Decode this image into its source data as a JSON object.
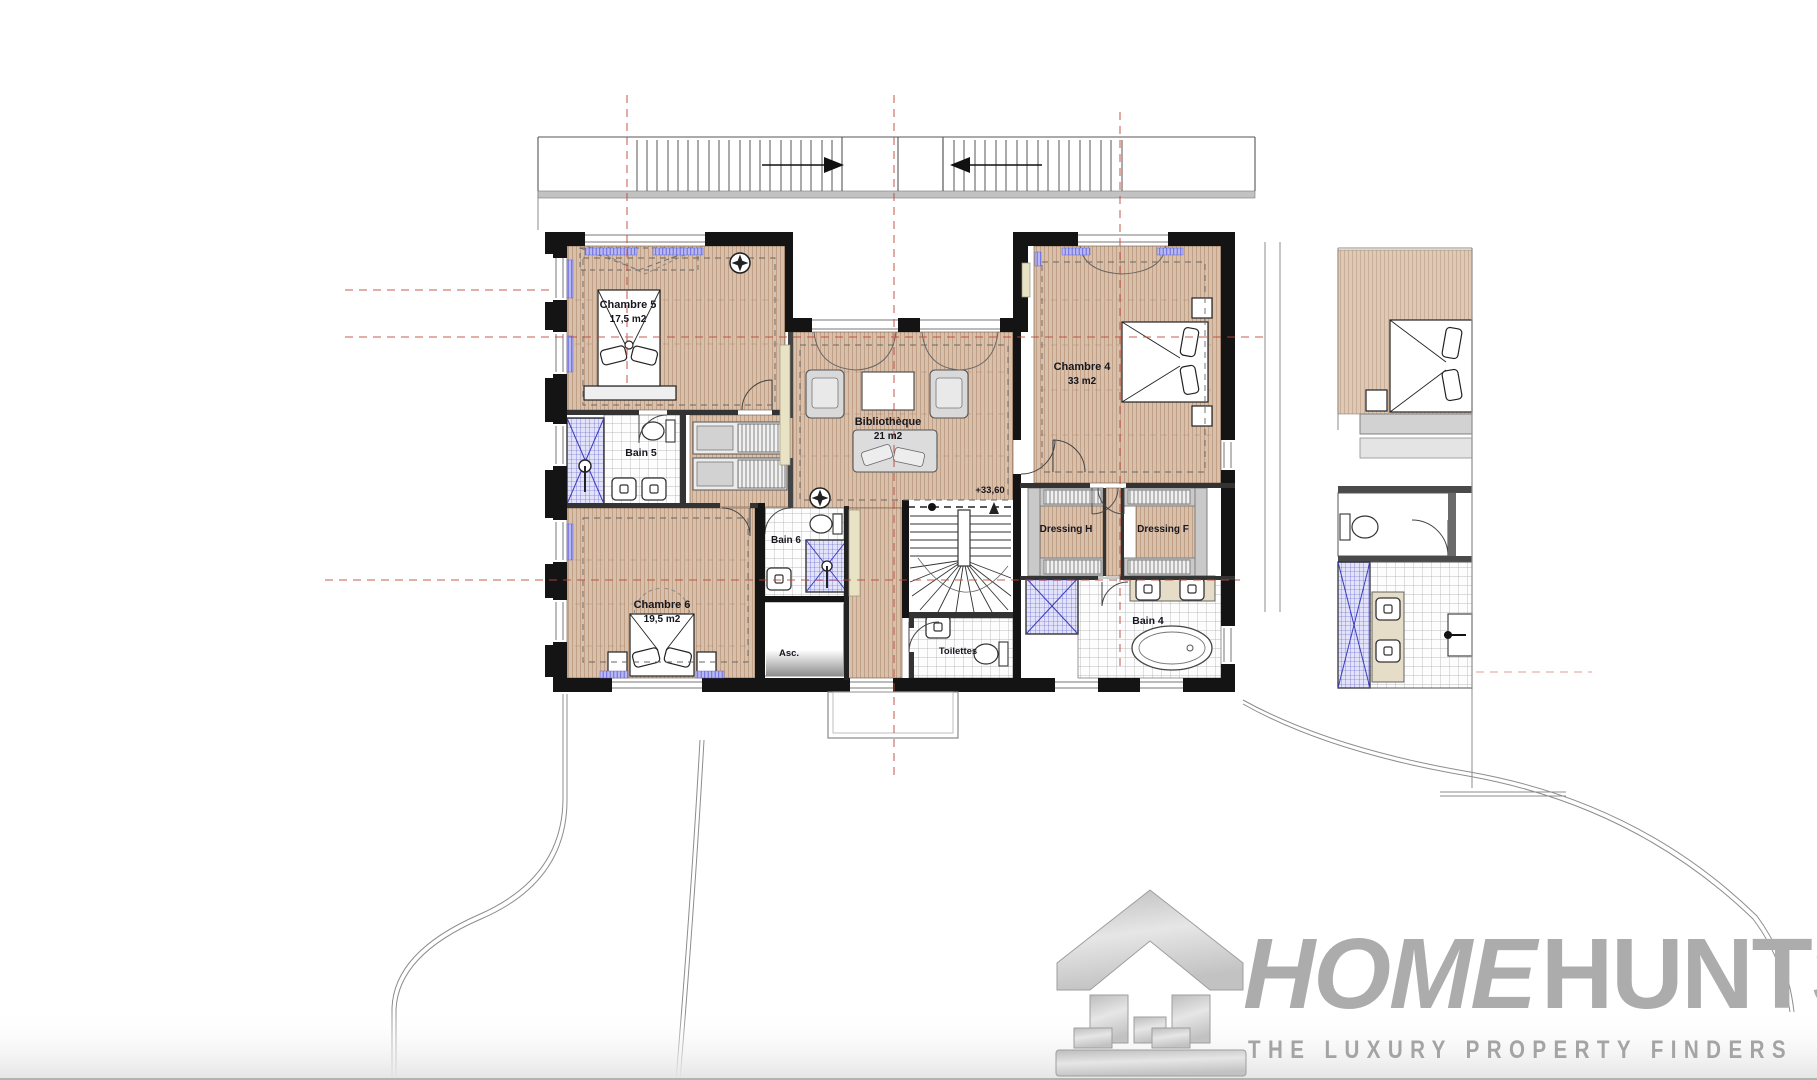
{
  "plan": {
    "rooms": {
      "chambre5": {
        "name": "Chambre 5",
        "area": "17,5 m2"
      },
      "bain5": {
        "name": "Bain 5"
      },
      "chambre6": {
        "name": "Chambre 6",
        "area": "19,5 m2"
      },
      "bain6": {
        "name": "Bain 6"
      },
      "ascenseur": {
        "name": "Asc."
      },
      "toilettes": {
        "name": "Toilettes"
      },
      "bibliotheque": {
        "name": "Bibliothèque",
        "area": "21 m2"
      },
      "chambre4": {
        "name": "Chambre 4",
        "area": "33 m2"
      },
      "dressing_h": {
        "name": "Dressing H"
      },
      "dressing_f": {
        "name": "Dressing F"
      },
      "bain4": {
        "name": "Bain 4"
      }
    },
    "level_marker": "+33,60"
  },
  "branding": {
    "logo_part1": "HOME",
    "logo_part2": "HUNTS",
    "tagline": "THE LUXURY PROPERTY FINDERS"
  },
  "colors": {
    "wall_black": "#141414",
    "wood_floor": "#d9c0ab",
    "wood_stripe": "#a87f64",
    "shower_blue": "#4a4ac8",
    "radiator_blue": "#8585e8",
    "elevator_door_magenta": "#e06ae0",
    "axis_red": "#c0453a",
    "closet_gray": "#c9c9c9",
    "logo_gray": "#acacac"
  }
}
